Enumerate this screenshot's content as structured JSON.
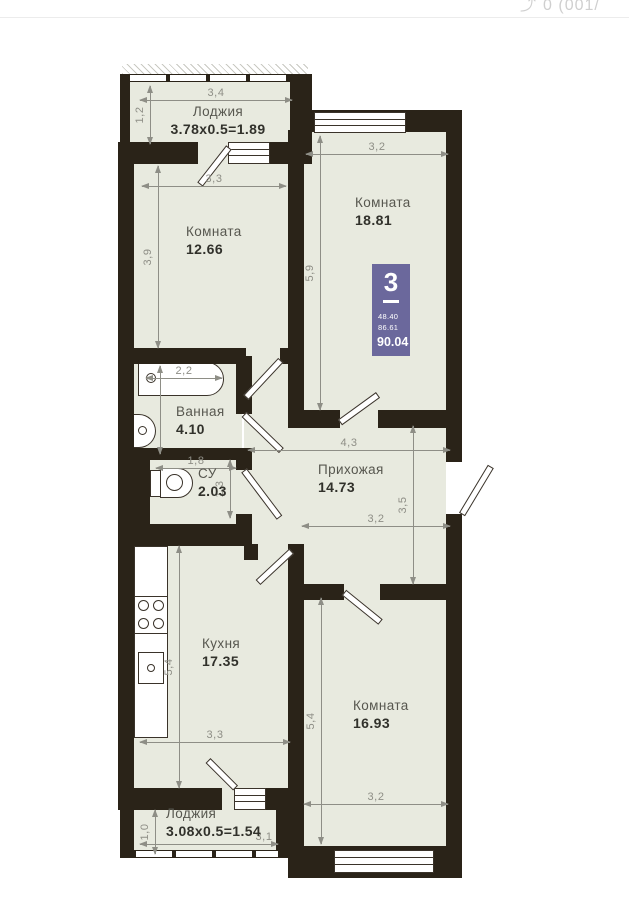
{
  "page": {
    "header_icon_glyph": "⤴",
    "header_fragment": "0 (001/"
  },
  "plan": {
    "colors": {
      "wall": "#2a2318",
      "floor": "#e8eadf",
      "dim": "#8e8e86",
      "label": "#57574f",
      "area": "#31312b",
      "badge": "#6b689c"
    },
    "badge": {
      "rooms": "3",
      "area1": "48.40",
      "area2": "86.61",
      "total": "90.04"
    },
    "rooms": [
      {
        "name": "Лоджия",
        "area": "3.78x0.5=1.89",
        "x": 218,
        "y": 104,
        "align": "center"
      },
      {
        "name": "Комната",
        "area": "12.66",
        "x": 186,
        "y": 224
      },
      {
        "name": "Комната",
        "area": "18.81",
        "x": 355,
        "y": 195
      },
      {
        "name": "Ванная",
        "area": "4.10",
        "x": 176,
        "y": 404
      },
      {
        "name": "СУ",
        "area": "2.03",
        "x": 198,
        "y": 466
      },
      {
        "name": "Прихожая",
        "area": "14.73",
        "x": 318,
        "y": 462
      },
      {
        "name": "Кухня",
        "area": "17.35",
        "x": 202,
        "y": 636
      },
      {
        "name": "Комната",
        "area": "16.93",
        "x": 353,
        "y": 698
      },
      {
        "name": "Лоджия",
        "area": "3.08x0.5=1.54",
        "x": 166,
        "y": 806
      }
    ],
    "dimensions": [
      {
        "label": "3,4",
        "o": "h",
        "x": 140,
        "y": 100,
        "len": 152
      },
      {
        "label": "1,2",
        "o": "v",
        "x": 150,
        "y": 86,
        "len": 58
      },
      {
        "label": "3,3",
        "o": "h",
        "x": 142,
        "y": 186,
        "len": 144
      },
      {
        "label": "3,9",
        "o": "v",
        "x": 158,
        "y": 166,
        "len": 182
      },
      {
        "label": "3,2",
        "o": "h",
        "x": 306,
        "y": 154,
        "len": 142
      },
      {
        "label": "5,9",
        "o": "v",
        "x": 320,
        "y": 136,
        "len": 274
      },
      {
        "label": "2,2",
        "o": "h",
        "x": 146,
        "y": 378,
        "len": 76
      },
      {
        "label": "",
        "o": "v",
        "x": 160,
        "y": 366,
        "len": 88
      },
      {
        "label": "1,8",
        "o": "h",
        "x": 156,
        "y": 468,
        "len": 80
      },
      {
        "label": "1,3",
        "o": "v",
        "x": 230,
        "y": 460,
        "len": 58
      },
      {
        "label": "4,3",
        "o": "h",
        "x": 248,
        "y": 450,
        "len": 202
      },
      {
        "label": "3,5",
        "o": "v",
        "x": 413,
        "y": 426,
        "len": 158
      },
      {
        "label": "3,2",
        "o": "h",
        "x": 302,
        "y": 526,
        "len": 148
      },
      {
        "label": "5,4",
        "o": "v",
        "x": 179,
        "y": 546,
        "len": 242
      },
      {
        "label": "3,3",
        "o": "h",
        "x": 140,
        "y": 742,
        "len": 150
      },
      {
        "label": "5,4",
        "o": "v",
        "x": 321,
        "y": 598,
        "len": 246
      },
      {
        "label": "3,2",
        "o": "h",
        "x": 304,
        "y": 804,
        "len": 144
      },
      {
        "label": "1,0",
        "o": "v",
        "x": 155,
        "y": 810,
        "len": 44
      },
      {
        "label": "3,1",
        "o": "h",
        "x": 140,
        "y": 844,
        "len": 138,
        "label_dx": 55
      }
    ]
  }
}
